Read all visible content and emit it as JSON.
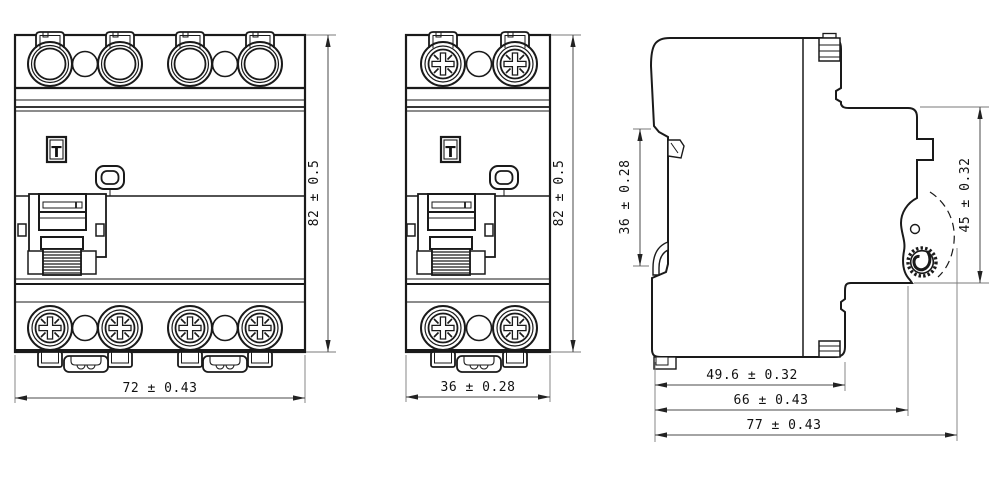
{
  "drawing": {
    "type": "engineering-dimension-drawing",
    "views": {
      "front_4pole": {
        "name": "front view, 4-module breaker",
        "width_dim": "72 ± 0.43",
        "height_dim": "82 ± 0.5",
        "test_button_label": "T"
      },
      "front_2pole": {
        "name": "front view, 2-module breaker",
        "width_dim": "36 ± 0.28",
        "height_dim": "82 ± 0.5",
        "test_button_label": "T"
      },
      "side": {
        "name": "side view",
        "rail_height_dim": "36 ± 0.28",
        "front_height_dim": "45 ± 0.32",
        "depth_dim_1": "49.6 ± 0.32",
        "depth_dim_2": "66 ± 0.43",
        "depth_dim_3": "77 ± 0.43"
      }
    },
    "colors": {
      "line": "#1a1a1a",
      "dimension": "#4a4a4a",
      "background": "#ffffff"
    }
  }
}
